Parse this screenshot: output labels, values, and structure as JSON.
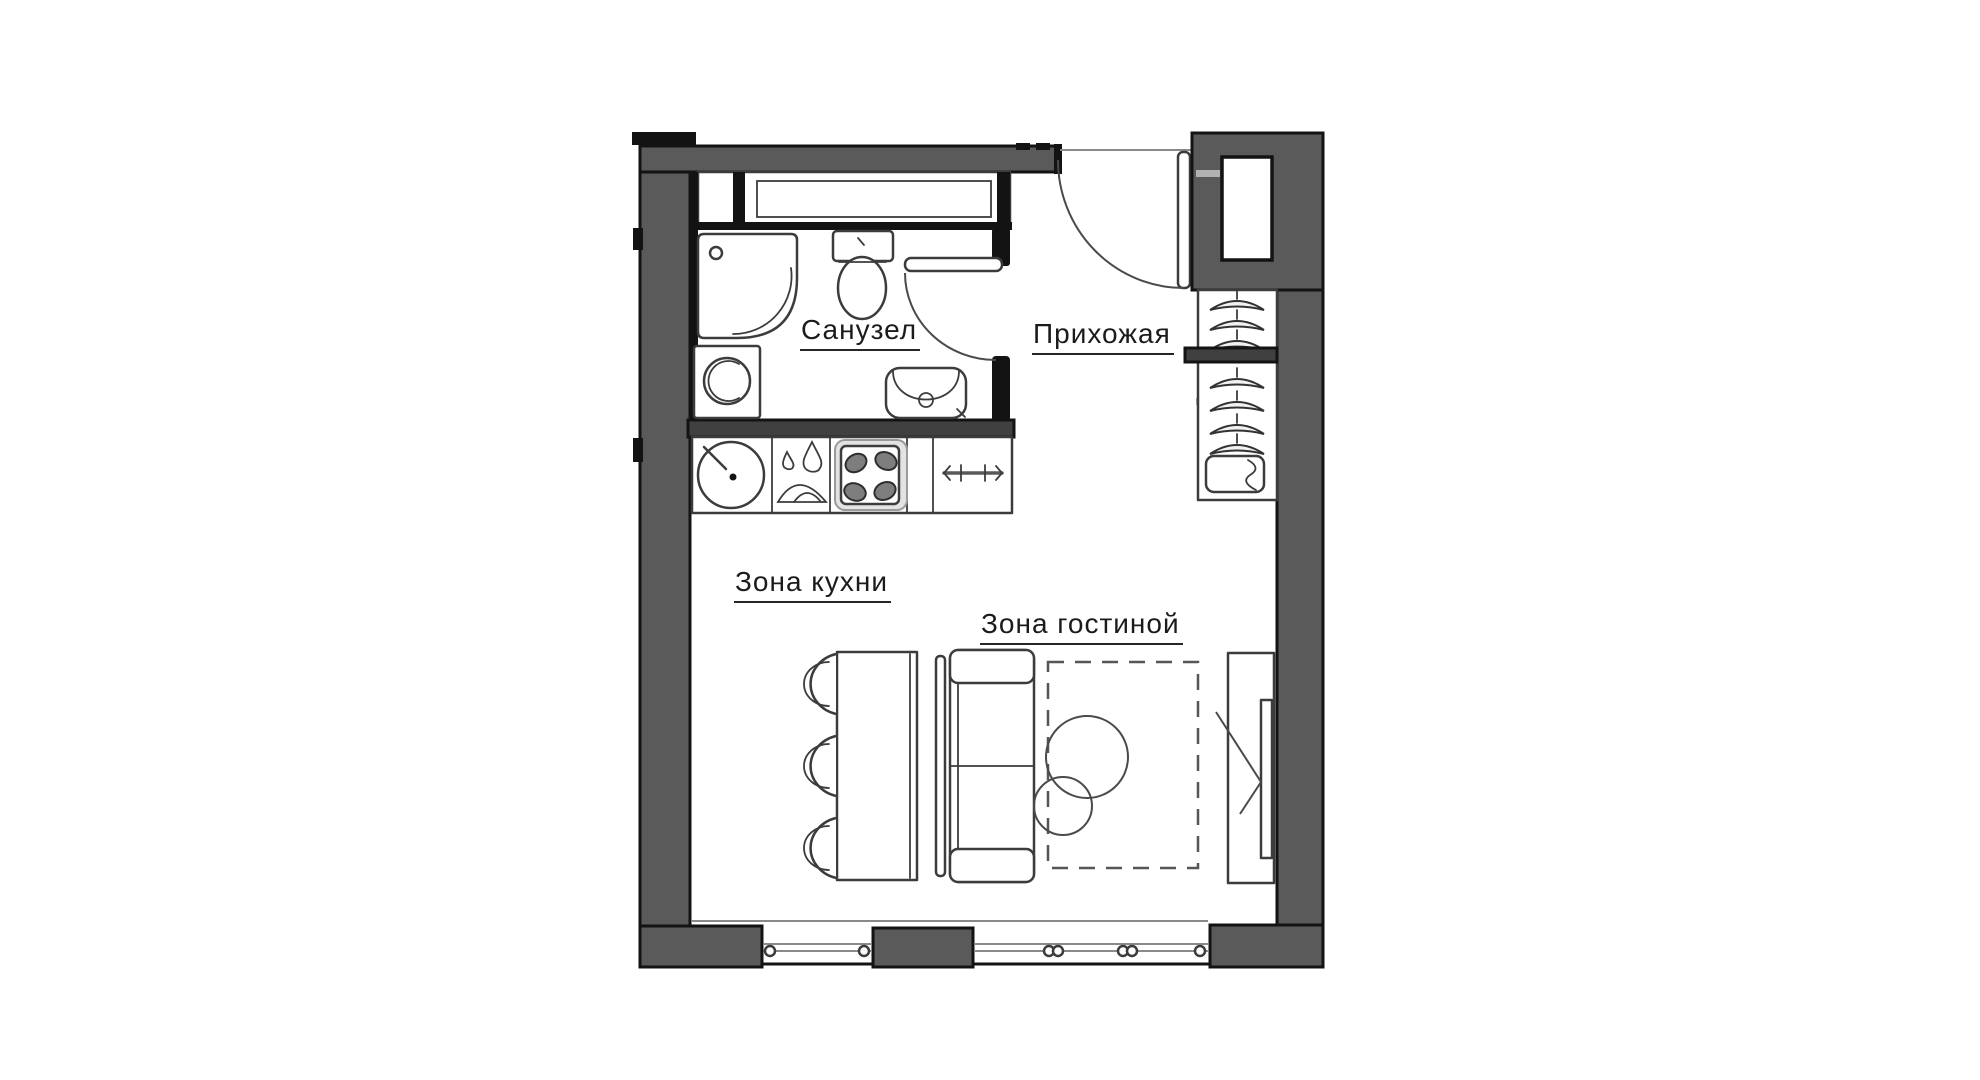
{
  "document": {
    "type": "apartment-floor-plan",
    "style": "hand-drawn studio layout, top view"
  },
  "colors": {
    "wall_fill": "#5a5a5a",
    "wall_dark": "#404040",
    "outline": "#131313",
    "line": "#3c3c3c",
    "line_light": "#8a8a8a",
    "background": "#ffffff",
    "text": "#1b1b1b"
  },
  "rooms": {
    "bathroom": {
      "label": "Санузел",
      "fixtures": [
        "shower",
        "washing-machine",
        "toilet",
        "sink",
        "swing-door"
      ]
    },
    "hallway": {
      "label": "Прихожая",
      "fixtures": [
        "entrance-door",
        "utility-closet",
        "open-wardrobe-with-hangers",
        "shelf",
        "storage-box"
      ]
    },
    "kitchen": {
      "label": "Зона кухни",
      "fixtures": [
        "kitchen-sink",
        "drying-rack",
        "hob-4-burners",
        "towel-rail",
        "counter"
      ]
    },
    "living": {
      "label": "Зона гостиной",
      "fixtures": [
        "dining-table",
        "three-chairs",
        "sofa",
        "dashed-rug",
        "coffee-tables",
        "tv-console"
      ]
    }
  },
  "icons": [
    "shower-icon",
    "washing-machine-icon",
    "toilet-icon",
    "bathroom-sink-icon",
    "kitchen-sink-icon",
    "drying-rack-icon",
    "hob-icon",
    "towel-rail-icon",
    "hanger-icon",
    "storage-box-icon",
    "entrance-door-icon",
    "bathroom-door-icon",
    "chair-icon",
    "sofa-icon",
    "tv-icon",
    "window-icon"
  ]
}
